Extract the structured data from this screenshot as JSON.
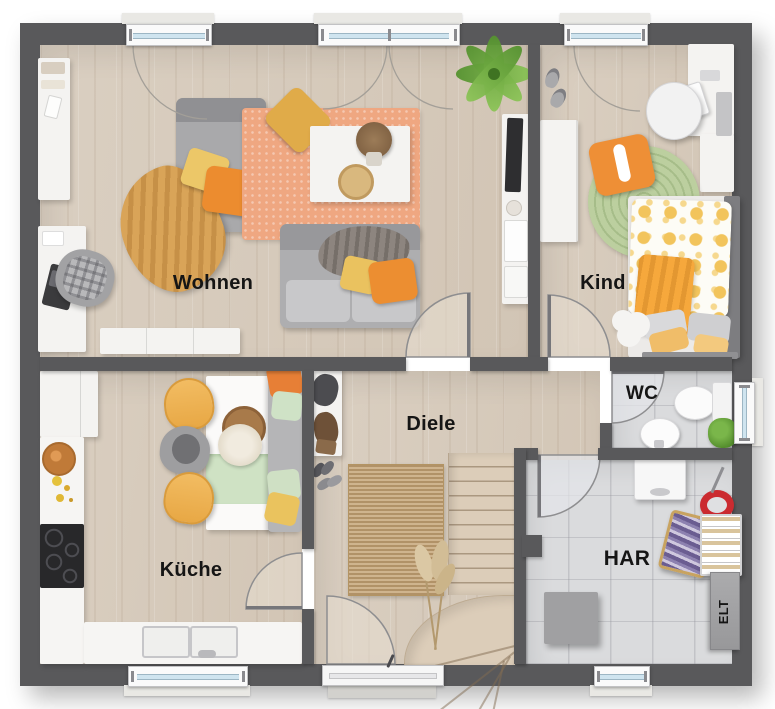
{
  "rooms": {
    "wohnen": {
      "label": "Wohnen"
    },
    "kind": {
      "label": "Kind"
    },
    "kueche": {
      "label": "Küche"
    },
    "diele": {
      "label": "Diele"
    },
    "wc": {
      "label": "WC"
    },
    "har": {
      "label": "HAR",
      "elt_label": "ELT"
    }
  },
  "colors": {
    "wall": "#59595b",
    "wood_floor": "#d7cbbd",
    "tile_floor": "#dadbdd",
    "rug_salmon": "#efa781",
    "rug_green": "#bccf9f",
    "rug_jute": "#c7a87c",
    "accent_orange": "#ec8c2f",
    "accent_yellow": "#eac25f",
    "window_glass": "#cfe4ef"
  }
}
